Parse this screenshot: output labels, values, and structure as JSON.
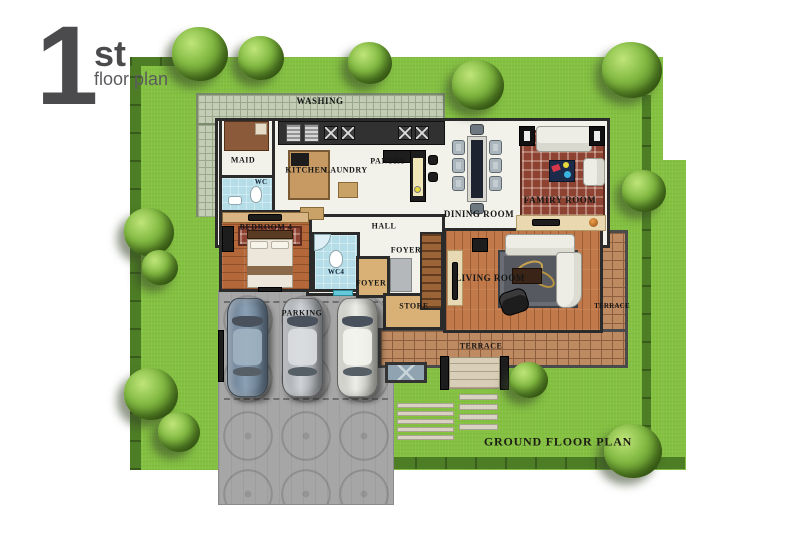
{
  "title": {
    "big": "1",
    "sup": "st",
    "sub": "floor plan"
  },
  "caption": "GROUND FLOOR PLAN",
  "labels": {
    "washing": "WASHING",
    "maid": "MAID",
    "wc": "WC",
    "kitchen": "KITCHEN",
    "laundry": "LAUNDRY",
    "pantry": "PANTRY",
    "bedroom4": "BEDROOM 4",
    "hall": "HALL",
    "dining": "DINING ROOM",
    "family": "FAMIRY ROOM",
    "foyer_inner": "FOYER",
    "wc4": "WC4",
    "foyer_entry": "FOYER",
    "store": "STORE",
    "living": "LIVING ROOM",
    "parking": "PARKING",
    "terrace_side": "TERRACE",
    "terrace_bottom": "TERRACE"
  },
  "palette": {
    "lawn": "#84c141",
    "hedge": "#4d7d25",
    "wall": "#2b2b2b",
    "floor": "#f2f1ea",
    "wood": "#b4683a",
    "wood2": "#c1794a",
    "brick": "#bd8a62",
    "brickLine": "#8d5f3e",
    "tile": "#c3cdb6",
    "tileLine": "#9aa98c",
    "blue": "#b5dde8",
    "tan": "#d9b176",
    "pave": "#a6a6a6",
    "ink": "#161616",
    "titleGray": "#4b4b4e",
    "subGray": "#5a5b5e"
  }
}
